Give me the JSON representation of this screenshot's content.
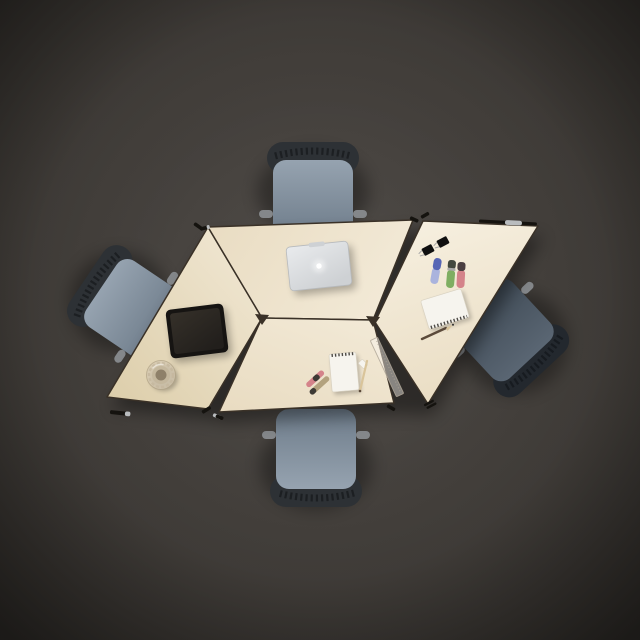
{
  "meta": {
    "description": "Top-down photo of a diamond-shaped modular meeting table made of four light maple trapezoid segments, surrounded by four blue-grey task chairs on a dark grey floor, with a silver laptop, black tablet, glass cup, spiral notepads, highlighter markers, pencils, a clear ruler and binder clips on the tabletop."
  },
  "colors": {
    "floor_center": "#524e4a",
    "floor_mid": "#433f3b",
    "floor_edge": "#2f2c28",
    "table_lightest": "#f6efdf",
    "table_light": "#f2e9d6",
    "table_mid": "#e9dcc2",
    "table_dark": "#dccda9",
    "table_edge": "#3a3127",
    "chair_fabric_light": "#96a3b0",
    "chair_fabric": "#6d7b89",
    "chair_fabric_dark2_top": "#5a6673",
    "chair_fabric_dark2_bottom": "#3f4a55",
    "chair_band": "#2d3135",
    "chair_band_dark": "#23282e",
    "chair_armrest": "#84878a",
    "laptop_body_light": "#e9ebed",
    "laptop_body": "#ced1d4",
    "laptop_trim": "#b7babd",
    "laptop_logo": "#ffffff",
    "tablet_body": "#161412",
    "tablet_screen_light": "#353029",
    "tablet_screen_dark": "#221f1c",
    "cup_outer": "#d5c9b2",
    "cup_mid": "#c4b79d",
    "cup_inner": "#8e8069",
    "cup_rim": "#b2a488",
    "notepad": "#f6f4ee",
    "notepad_edge": "#d9d2c2",
    "spiral": "#4d4a45",
    "marker_pink": "#d4838a",
    "marker_olive": "#b3a27e",
    "marker_dark_tip": "#3d3a35",
    "marker_blue_cap": "#5766b5",
    "marker_blue_body": "#aab3dd",
    "marker_green": "#7fae62",
    "marker_green_cap": "#42483f",
    "marker_pink_cap": "#4a3f41",
    "pencil_wood": "#d9c49a",
    "pencil_dark": "#5b4a3a",
    "ruler_fill": "rgba(248,245,238,0.45)",
    "ruler_edge": "rgba(175,166,150,0.85)",
    "clip_black": "#101010",
    "clip_wire": "#a8a8a8",
    "clamp_black": "#15130f",
    "clamp_silver": "#b9bcbe",
    "shadow": "#000000"
  },
  "objects": {
    "scene": "modular trapezoid meeting table set, top view",
    "floor": "dark grey floor",
    "table_left": "left trapezoid table segment",
    "table_top": "top trapezoid table segment",
    "table_bottom": "bottom trapezoid table segment",
    "table_right": "right trapezoid table segment",
    "chair_top": "task chair, top",
    "chair_left": "task chair, left",
    "chair_bottom": "task chair, bottom",
    "chair_right": "task chair, right",
    "laptop": "closed silver laptop",
    "tablet": "black tablet",
    "cup": "glass cup",
    "notepad_bottom": "spiral notepad",
    "notepad_right": "spiral notepad",
    "markers_bottom": "two markers",
    "marker_blue": "blue marker",
    "marker_green": "green highlighter",
    "marker_pink": "pink highlighter",
    "binder_clips": "two binder clips",
    "pencil_bottom": "pencil",
    "pencil_right": "pencil",
    "ruler": "transparent ruler",
    "eraser": "eraser"
  }
}
